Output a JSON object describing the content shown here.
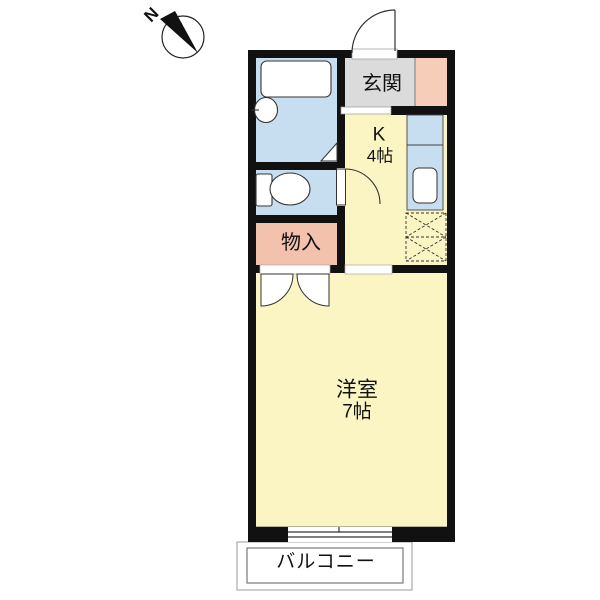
{
  "compass": {
    "label": "N"
  },
  "rooms": {
    "entrance": {
      "label": "玄関"
    },
    "kitchen": {
      "label": "K",
      "size": "4帖"
    },
    "storage": {
      "label": "物入"
    },
    "western_room": {
      "label": "洋室",
      "size": "7帖"
    },
    "balcony": {
      "label": "バルコニー"
    }
  },
  "colors": {
    "wall": "#111111",
    "line": "#333333",
    "room_yellow": "#FAF5C2",
    "water_blue": "#C6DEF0",
    "storage_pink": "#F2C2AD",
    "shoe_pink": "#F5CDB8",
    "entrance_gray": "#DBDBDB",
    "white": "#FFFFFF"
  }
}
